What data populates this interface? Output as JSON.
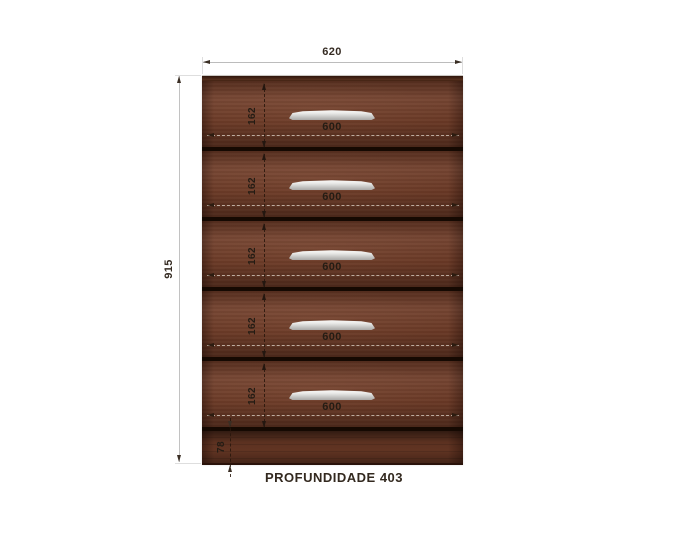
{
  "dimensions": {
    "overall_width": "620",
    "overall_height": "915",
    "base_height": "78",
    "depth_label": "PROFUNDIDADE 403"
  },
  "drawers": [
    {
      "height_label": "162",
      "width_label": "600"
    },
    {
      "height_label": "162",
      "width_label": "600"
    },
    {
      "height_label": "162",
      "width_label": "600"
    },
    {
      "height_label": "162",
      "width_label": "600"
    },
    {
      "height_label": "162",
      "width_label": "600"
    }
  ],
  "colors": {
    "wood": "#6e3b27",
    "drawer_gap": "#150902",
    "handle": "#dddddc",
    "dimension_line": "#bcbcbc",
    "text": "#352b22"
  }
}
